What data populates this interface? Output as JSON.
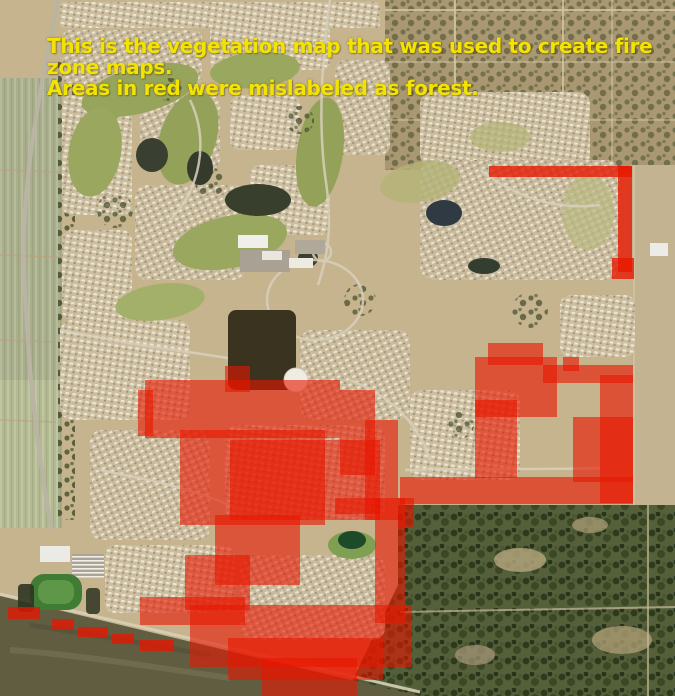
{
  "map": {
    "type": "satellite-vegetation-map",
    "caption": {
      "line1": "This is the vegetation map that was used to create fire zone maps.",
      "line2": "Areas in red were mislabeled as forest.",
      "color": "#f2e400"
    },
    "overlay": {
      "meaning": "Areas mislabeled as forest",
      "color": "#e81600",
      "dash_opacity": 0.78,
      "regions": [
        {
          "id": "top-right-L-strip",
          "opacity": 0.78,
          "rects": [
            [
              489,
              166,
              143,
              11
            ],
            [
              618,
              166,
              14,
              106
            ],
            [
              612,
              258,
              22,
              21
            ]
          ]
        },
        {
          "id": "central-blob",
          "opacity": 0.6,
          "rects": [
            [
              225,
              366,
              25,
              26
            ],
            [
              145,
              380,
              195,
              58
            ],
            [
              138,
              390,
              15,
              46
            ],
            [
              180,
              430,
              145,
              95
            ],
            [
              230,
              440,
              150,
              80
            ],
            [
              340,
              390,
              35,
              85
            ],
            [
              365,
              420,
              33,
              100
            ],
            [
              375,
              498,
              30,
              125
            ],
            [
              335,
              498,
              45,
              16
            ],
            [
              215,
              515,
              85,
              70
            ],
            [
              185,
              555,
              65,
              55
            ],
            [
              140,
              597,
              105,
              28
            ],
            [
              190,
              605,
              222,
              62
            ],
            [
              228,
              638,
              155,
              42
            ],
            [
              262,
              658,
              95,
              38
            ]
          ]
        },
        {
          "id": "right-horseshoe-blob",
          "opacity": 0.62,
          "rects": [
            [
              488,
              343,
              55,
              22
            ],
            [
              475,
              357,
              82,
              60
            ],
            [
              475,
              400,
              42,
              78
            ],
            [
              543,
              365,
              90,
              18
            ],
            [
              563,
              357,
              16,
              14
            ],
            [
              600,
              375,
              33,
              128
            ],
            [
              573,
              417,
              60,
              65
            ],
            [
              400,
              477,
              233,
              27
            ],
            [
              398,
              498,
              16,
              30
            ]
          ]
        }
      ],
      "dashes": [
        [
          8,
          607,
          32,
          12
        ],
        [
          52,
          619,
          22,
          10
        ],
        [
          78,
          627,
          30,
          10
        ],
        [
          112,
          634,
          22,
          10
        ],
        [
          140,
          640,
          34,
          11
        ]
      ]
    },
    "terrain_legend": [
      {
        "name": "suburban housing / golf course community",
        "color": "#c6b48e"
      },
      {
        "name": "irrigated farm fields (west edge)",
        "color": "#a9ae8b"
      },
      {
        "name": "rural parcels with trees (northeast)",
        "color": "#a99871"
      },
      {
        "name": "oak woodland (southeast)",
        "color": "#57613c"
      },
      {
        "name": "open dry field (southwest)",
        "color": "#615d41"
      },
      {
        "name": "ponds / water",
        "color": "#2f3a42"
      }
    ]
  }
}
